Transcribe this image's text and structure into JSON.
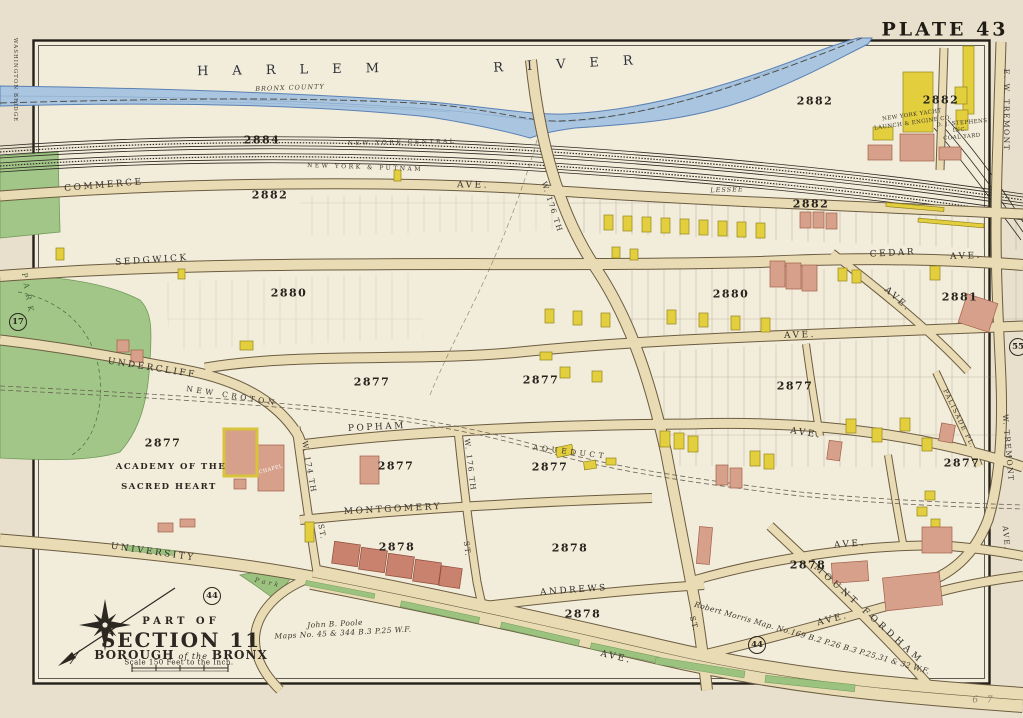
{
  "plate": {
    "title": "PLATE 43",
    "page_note": "6 7"
  },
  "river": {
    "word1": "HARLEM",
    "word2": "RIVER",
    "boundary": "BRONX COUNTY"
  },
  "railroads": {
    "central": "NEW YORK CENTRAL",
    "putnam": "NEW YORK & PUTNAM",
    "lessee": "LESSEE"
  },
  "streets": {
    "commerce": "COMMERCE",
    "commerce_ave": "AVE.",
    "sedgwick": "SEDGWICK",
    "cedar": "CEDAR",
    "cedar_ave": "AVE.",
    "mid_ave": "AVE.",
    "undercliff": "UNDERCLIFF",
    "popham": "POPHAM",
    "popham_ext_ave": "AVE.",
    "montgomery": "MONTGOMERY",
    "andrews": "ANDREWS",
    "university": "UNIVERSITY",
    "blvd_ave": "AVE.",
    "mount_fordham": "MOUNT FORDHAM",
    "r1_ave": "AVE.",
    "r3_ave": "AVE.",
    "diag_ave": "AVE.",
    "w176_upper": "W. 176 TH",
    "w176_lower": "W. 176 TH",
    "w176_st": "ST.",
    "w174": "W. 174 TH",
    "w174_st": "ST.",
    "diag_st": "ST.",
    "tremont_top": "E. W. TREMONT",
    "tremont_mid": "W. TREMONT",
    "tremont_ave": "AVE.",
    "palisade": "PALISADE PL.",
    "washington_bridge": "WASHINGTON BRIDGE"
  },
  "aqueduct": {
    "new_croton": "NEW CROTON",
    "label": "AQUEDUCT"
  },
  "parks": {
    "left_park": "PARK",
    "triangle": "Park"
  },
  "places": {
    "academy_line1": "ACADEMY OF THE",
    "academy_line2": "SACRED HEART",
    "chapel": "CHAPEL",
    "yacht_line1": "NEW YORK YACHT",
    "yacht_line2": "LAUNCH & ENGINE CO.",
    "coal_line1": "D. J. STEPHENS",
    "coal_line2": "INC.",
    "coal_line3": "COAL YARD"
  },
  "blocks": {
    "b2884": "2884",
    "b2882_left": "2882",
    "b2882_river": "2882",
    "b2882_corner": "2882",
    "b2882_lower": "2882",
    "b2880_left": "2880",
    "b2880_right": "2880",
    "b2881": "2881",
    "b2877_a": "2877",
    "b2877_b": "2877",
    "b2877_c": "2877",
    "b2877_d": "2877",
    "b2877_e": "2877",
    "b2877_f": "2877",
    "b2877_g": "2877",
    "b2878_a": "2878",
    "b2878_b": "2878",
    "b2878_c": "2878",
    "b2878_d": "2878"
  },
  "circles": {
    "c17": "17",
    "c44_left": "44",
    "c44_right": "44",
    "c55": "55"
  },
  "title_block": {
    "part_of": "PART OF",
    "section": "SECTION 11",
    "borough_word1": "BOROUGH",
    "borough_word2": "of the",
    "borough_word3": "BRONX",
    "scale_note": "Scale 150 Feet to the Inch."
  },
  "credits": {
    "poole_line1": "John B. Poole",
    "poole_line2": "Maps No. 45 & 344 B.3 P.25 W.F.",
    "morris": "Robert Morris Map. No.169 B.2 P.26 B.3 P.25,31 & 32 W.F."
  },
  "colors": {
    "paper": "#e8e0cc",
    "paper_inner": "#f2ecdb",
    "river": "#a9c5df",
    "street": "#e9dbb4",
    "park": "#a2c687",
    "building_frame": "#e3cf3d",
    "building_brick": "#d6a08b",
    "ink": "#2b2721"
  }
}
